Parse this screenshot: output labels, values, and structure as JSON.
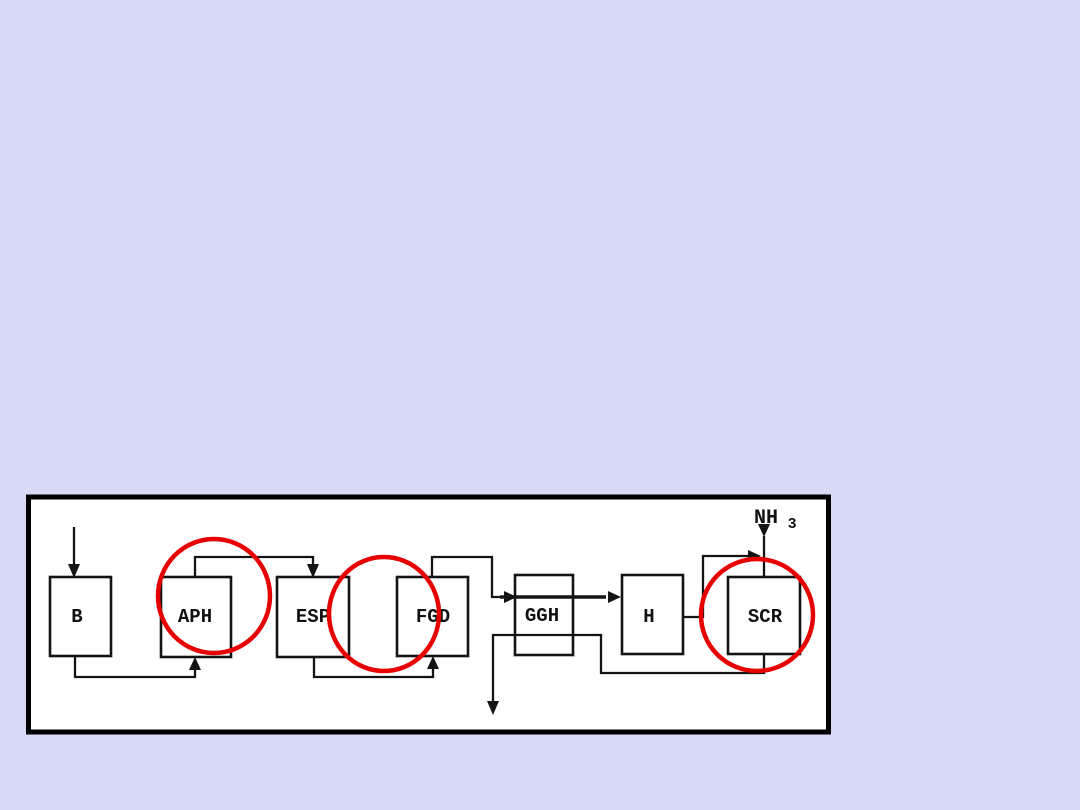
{
  "page": {
    "background_color": "#d7d9f7"
  },
  "panel": {
    "background_color": "#ffffff",
    "border_color": "#000000"
  },
  "diagram": {
    "type": "process-flow",
    "line_color": "#141414",
    "text_color": "#111111",
    "highlight_color": "#e60000",
    "boxes": [
      {
        "label": "B"
      },
      {
        "label": "APH"
      },
      {
        "label": "ESP"
      },
      {
        "label": "FGD"
      },
      {
        "label": "GGH"
      },
      {
        "label": "H"
      },
      {
        "label": "SCR"
      }
    ],
    "nh3": {
      "text": "NH",
      "subscript": "3"
    },
    "highlight_circles": [
      "APH",
      "ESP-FGD",
      "SCR"
    ]
  }
}
